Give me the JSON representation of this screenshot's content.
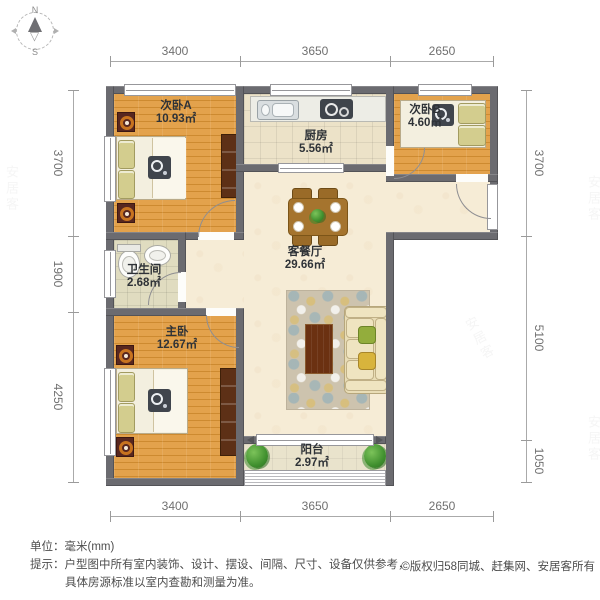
{
  "compass": {
    "north": "N",
    "south": "S"
  },
  "dimensions": {
    "top": [
      "3400",
      "3650",
      "2650"
    ],
    "bottom": [
      "3400",
      "3650",
      "2650"
    ],
    "left": [
      "3700",
      "1900",
      "4250"
    ],
    "right": [
      "3700",
      "5100",
      "1050"
    ]
  },
  "rooms": [
    {
      "name": "次卧A",
      "area": "10.93㎡"
    },
    {
      "name": "厨房",
      "area": "5.56㎡"
    },
    {
      "name": "次卧B",
      "area": "4.60㎡"
    },
    {
      "name": "卫生间",
      "area": "2.68㎡"
    },
    {
      "name": "客餐厅",
      "area": "29.66㎡"
    },
    {
      "name": "主卧",
      "area": "12.67㎡"
    },
    {
      "name": "阳台",
      "area": "2.97㎡"
    }
  ],
  "footer": {
    "unit_line": "单位：毫米(mm)",
    "tip_line1": "提示：户型图中所有室内装饰、设计、摆设、间隔、尺寸、设备仅供参考，",
    "tip_line2": "具体房源标准以室内查勘和测量为准。",
    "copyright": "©版权归58同城、赶集网、安居客所有"
  },
  "watermark": {
    "text": "安居客"
  },
  "colors": {
    "wall": "#6b6b70",
    "wood_floor": "#dd9a43",
    "living_floor": "#f6ecd6",
    "kitchen_floor": "#ece2c8",
    "bath_floor": "#e0dcc0",
    "balcony_floor": "#e9e3cc",
    "plant_green": "#3f8f2e",
    "dimension_text": "#707070"
  }
}
